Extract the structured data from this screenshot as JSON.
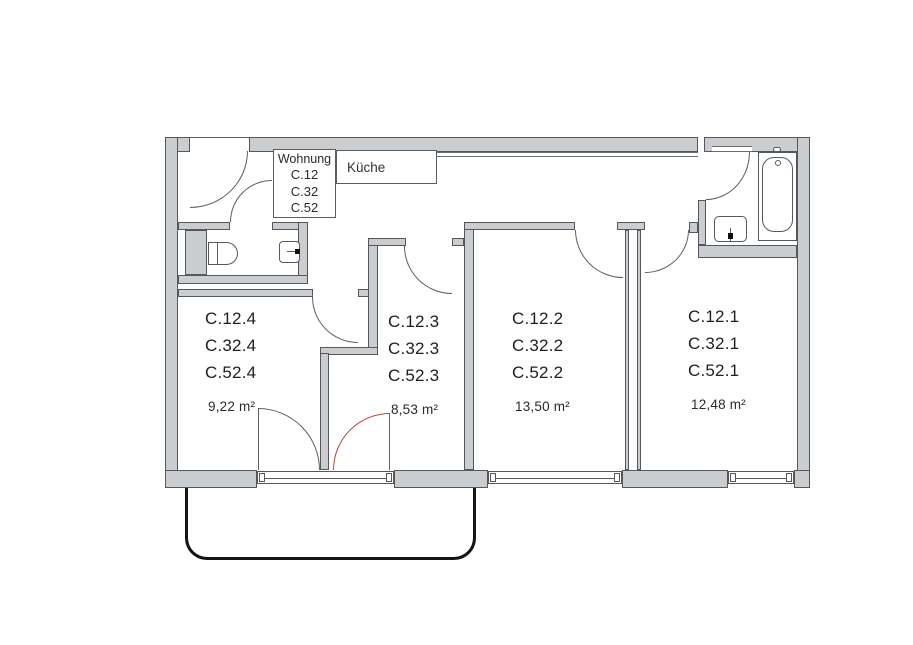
{
  "plan": {
    "title_box": {
      "line0": "Wohnung",
      "line1": "C.12",
      "line2": "C.32",
      "line3": "C.52"
    },
    "kitchen_label": "Küche",
    "rooms": [
      {
        "lines": [
          "C.12.4",
          "C.32.4",
          "C.52.4"
        ],
        "area": "9,22 m²"
      },
      {
        "lines": [
          "C.12.3",
          "C.32.3",
          "C.52.3"
        ],
        "area": "8,53 m²"
      },
      {
        "lines": [
          "C.12.2",
          "C.32.2",
          "C.52.2"
        ],
        "area": "13,50 m²"
      },
      {
        "lines": [
          "C.12.1",
          "C.32.1",
          "C.52.1"
        ],
        "area": "12,48 m²"
      }
    ],
    "fixtures": [
      "toilet",
      "wc-washbasin",
      "bath-washbasin",
      "bathtub"
    ],
    "colors": {
      "wall_fill": "#cbced1",
      "wall_outline": "#54585d",
      "door_arc": "#5a5e63",
      "alternate_door_red": "#b5463e",
      "balcony_outline": "#141414",
      "background": "#ffffff",
      "text": "#1f1f1f"
    }
  }
}
